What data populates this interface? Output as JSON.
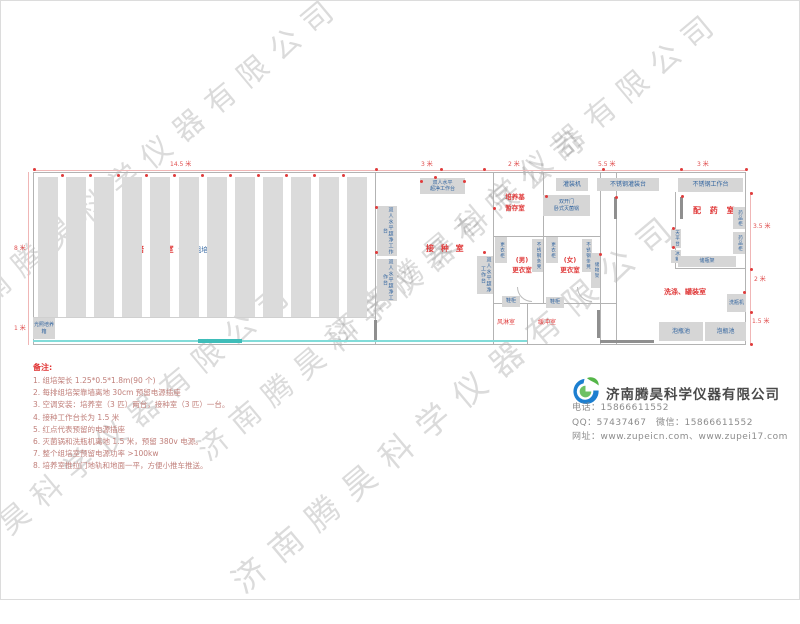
{
  "watermark": {
    "text": "济南腾昊科学仪器有限公司"
  },
  "dims": {
    "top_total": "14.5 米",
    "top_a": "3 米",
    "top_b": "2 米",
    "top_c": "5.5 米",
    "top_d": "3 米",
    "left_a": "8 米",
    "left_b": "1 米",
    "right_a": "3.5 米",
    "right_b": "2 米",
    "right_c": "1.5 米"
  },
  "rooms": {
    "culture_label": "培 养 室",
    "culture_sub": "90个组培架",
    "aisle": "过道0.6米",
    "inoculation": "接 种 室",
    "medium_line1": "培养基",
    "medium_line2": "暂存室",
    "male_line1": "(男)",
    "male_line2": "更衣室",
    "female_line1": "(女)",
    "female_line2": "更衣室",
    "air_shower": "风淋室",
    "buffer": "缓冲室",
    "dispensing": "配 药 室",
    "washing": "洗涤、罐装室"
  },
  "equipment": {
    "bench_line1": "双人水平",
    "bench_line2": "超净工作台",
    "bench_v": "双人水平超净工作台",
    "locker": "更衣柜",
    "steel_bench": "不锈钢条凳",
    "storage_rack": "储物架",
    "shoe_cabinet": "鞋柜",
    "autoclave_line1": "双开门",
    "autoclave_line2": "卧式灭菌锅",
    "filling_machine": "灌装机",
    "filling_table": "不锈钢灌装台",
    "work_table": "不锈钢工作台",
    "medicine_cabinet": "药品柜",
    "balance_table": "天平台",
    "fridge": "冰箱",
    "bottle_rack": "储瓶架",
    "bottle_washer": "洗瓶机",
    "soaking_pool": "泡瓶池",
    "light_incubator": "光照培养箱"
  },
  "notes": {
    "title": "备注:",
    "items": [
      "1. 组培架长 1.25*0.5*1.8m(90 个)",
      "2. 每排组培架靠墙离地 30cm 预留电源插座",
      "3. 空调安装：培养室（3 匹）两台，接种室（3 匹）一台。",
      "4. 接种工作台长为 1.5 米",
      "5. 红点代表预留的电源插座",
      "6. 灭菌锅和洗瓶机离地 1.5 米，预留 380v 电源。",
      "7. 整个组培室预留电源功率 >100kw",
      "8. 培养室推拉门地轨和地面一平，方便小推车推送。"
    ]
  },
  "company": {
    "name": "济南腾昊科学仪器有限公司",
    "contact_lines": [
      "电话：15866611552",
      "QQ：57437467　微信：15866611552",
      "网址：www.zupeicn.com、www.zupei17.com"
    ]
  }
}
